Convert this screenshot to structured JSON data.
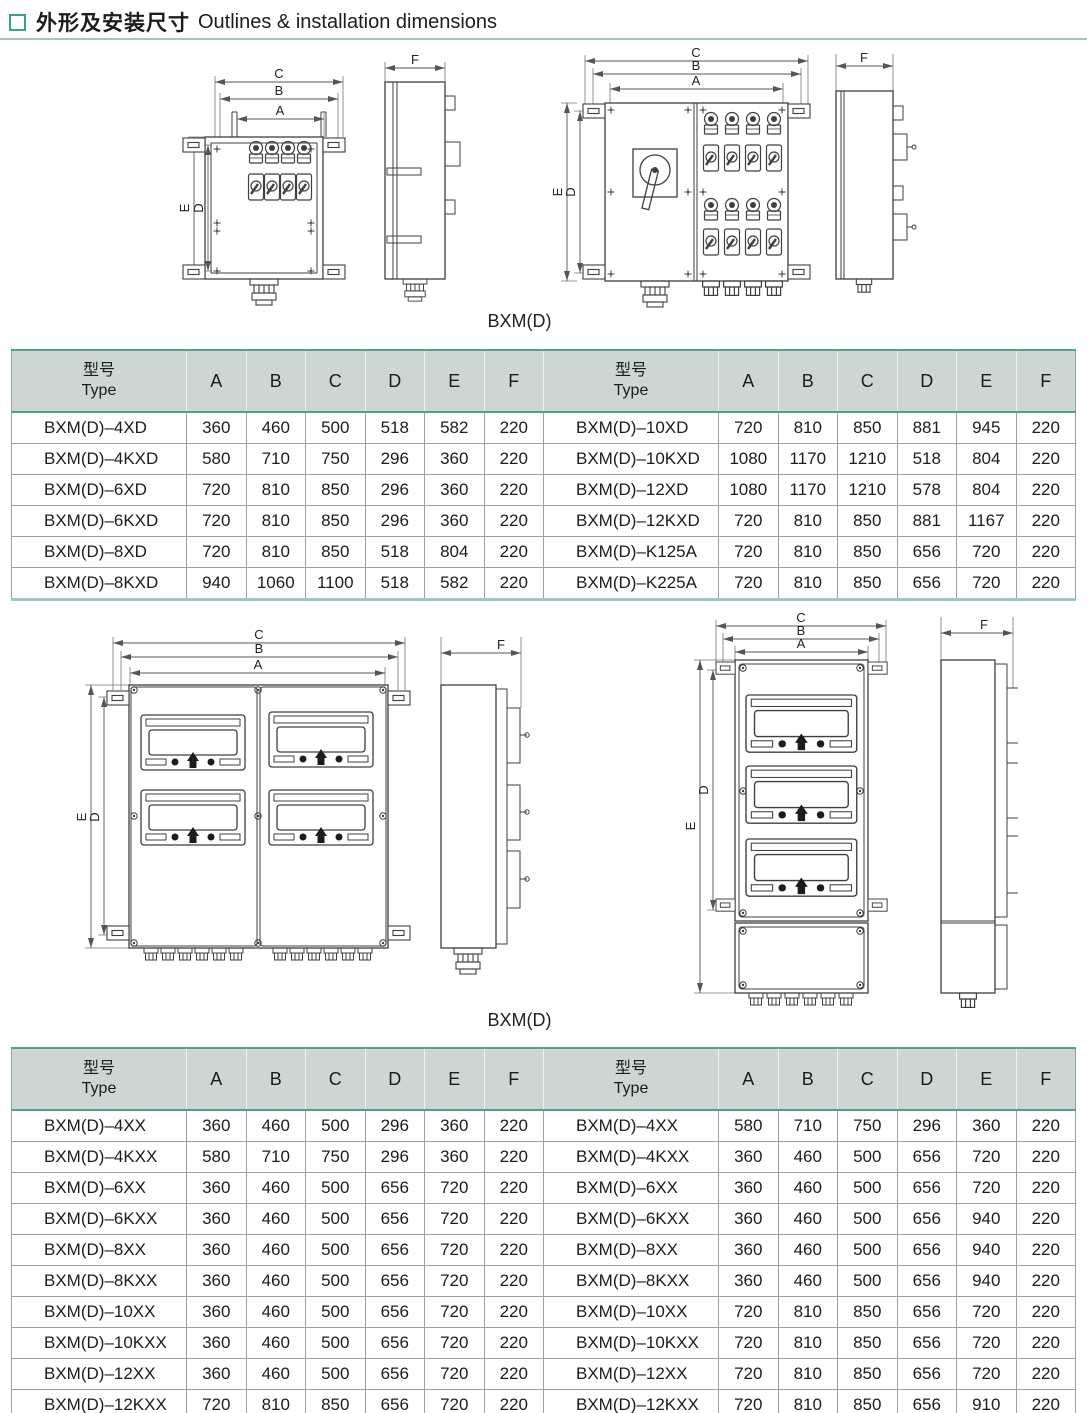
{
  "page": {
    "title_zh": "外形及安装尺寸",
    "title_en": "Outlines & installation dimensions"
  },
  "colors": {
    "accent_teal": "#4fa28a",
    "accent_teal_light": "#9ccabb",
    "header_bg": "#cdd6d2",
    "marker_green": "#35a87b"
  },
  "dims": {
    "A": "A",
    "B": "B",
    "C": "C",
    "D": "D",
    "E": "E",
    "F": "F"
  },
  "figures": {
    "fig1_caption": "BXM(D)",
    "fig2_caption": "BXM(D)"
  },
  "table_header": {
    "type_zh": "型号",
    "type_en": "Type",
    "cols": [
      "A",
      "B",
      "C",
      "D",
      "E",
      "F"
    ]
  },
  "table1": {
    "left": [
      {
        "type": "BXM(D)–4XD",
        "values": [
          360,
          460,
          500,
          518,
          582,
          220
        ]
      },
      {
        "type": "BXM(D)–4KXD",
        "values": [
          580,
          710,
          750,
          296,
          360,
          220
        ]
      },
      {
        "type": "BXM(D)–6XD",
        "values": [
          720,
          810,
          850,
          296,
          360,
          220
        ]
      },
      {
        "type": "BXM(D)–6KXD",
        "values": [
          720,
          810,
          850,
          296,
          360,
          220
        ]
      },
      {
        "type": "BXM(D)–8XD",
        "values": [
          720,
          810,
          850,
          518,
          804,
          220
        ]
      },
      {
        "type": "BXM(D)–8KXD",
        "values": [
          940,
          1060,
          1100,
          518,
          582,
          220
        ]
      }
    ],
    "right": [
      {
        "type": "BXM(D)–10XD",
        "values": [
          720,
          810,
          850,
          881,
          945,
          220
        ]
      },
      {
        "type": "BXM(D)–10KXD",
        "values": [
          1080,
          1170,
          1210,
          518,
          804,
          220
        ]
      },
      {
        "type": "BXM(D)–12XD",
        "values": [
          1080,
          1170,
          1210,
          578,
          804,
          220
        ]
      },
      {
        "type": "BXM(D)–12KXD",
        "values": [
          720,
          810,
          850,
          881,
          1167,
          220
        ]
      },
      {
        "type": "BXM(D)–K125A",
        "values": [
          720,
          810,
          850,
          656,
          720,
          220
        ]
      },
      {
        "type": "BXM(D)–K225A",
        "values": [
          720,
          810,
          850,
          656,
          720,
          220
        ]
      }
    ]
  },
  "table2": {
    "left": [
      {
        "type": "BXM(D)–4XX",
        "values": [
          360,
          460,
          500,
          296,
          360,
          220
        ]
      },
      {
        "type": "BXM(D)–4KXX",
        "values": [
          580,
          710,
          750,
          296,
          360,
          220
        ]
      },
      {
        "type": "BXM(D)–6XX",
        "values": [
          360,
          460,
          500,
          656,
          720,
          220
        ]
      },
      {
        "type": "BXM(D)–6KXX",
        "values": [
          360,
          460,
          500,
          656,
          720,
          220
        ]
      },
      {
        "type": "BXM(D)–8XX",
        "values": [
          360,
          460,
          500,
          656,
          720,
          220
        ]
      },
      {
        "type": "BXM(D)–8KXX",
        "values": [
          360,
          460,
          500,
          656,
          720,
          220
        ]
      },
      {
        "type": "BXM(D)–10XX",
        "values": [
          360,
          460,
          500,
          656,
          720,
          220
        ]
      },
      {
        "type": "BXM(D)–10KXX",
        "values": [
          360,
          460,
          500,
          656,
          720,
          220
        ]
      },
      {
        "type": "BXM(D)–12XX",
        "values": [
          360,
          460,
          500,
          656,
          720,
          220
        ]
      },
      {
        "type": "BXM(D)–12KXX",
        "values": [
          720,
          810,
          850,
          656,
          720,
          220
        ]
      }
    ],
    "right": [
      {
        "type": "BXM(D)–4XX",
        "values": [
          580,
          710,
          750,
          296,
          360,
          220
        ]
      },
      {
        "type": "BXM(D)–4KXX",
        "values": [
          360,
          460,
          500,
          656,
          720,
          220
        ]
      },
      {
        "type": "BXM(D)–6XX",
        "values": [
          360,
          460,
          500,
          656,
          720,
          220
        ]
      },
      {
        "type": "BXM(D)–6KXX",
        "values": [
          360,
          460,
          500,
          656,
          940,
          220
        ]
      },
      {
        "type": "BXM(D)–8XX",
        "values": [
          360,
          460,
          500,
          656,
          940,
          220
        ]
      },
      {
        "type": "BXM(D)–8KXX",
        "values": [
          360,
          460,
          500,
          656,
          940,
          220
        ]
      },
      {
        "type": "BXM(D)–10XX",
        "values": [
          720,
          810,
          850,
          656,
          720,
          220
        ]
      },
      {
        "type": "BXM(D)–10KXX",
        "values": [
          720,
          810,
          850,
          656,
          720,
          220
        ]
      },
      {
        "type": "BXM(D)–12XX",
        "values": [
          720,
          810,
          850,
          656,
          720,
          220
        ]
      },
      {
        "type": "BXM(D)–12KXX",
        "values": [
          720,
          810,
          850,
          656,
          910,
          220
        ]
      }
    ]
  }
}
